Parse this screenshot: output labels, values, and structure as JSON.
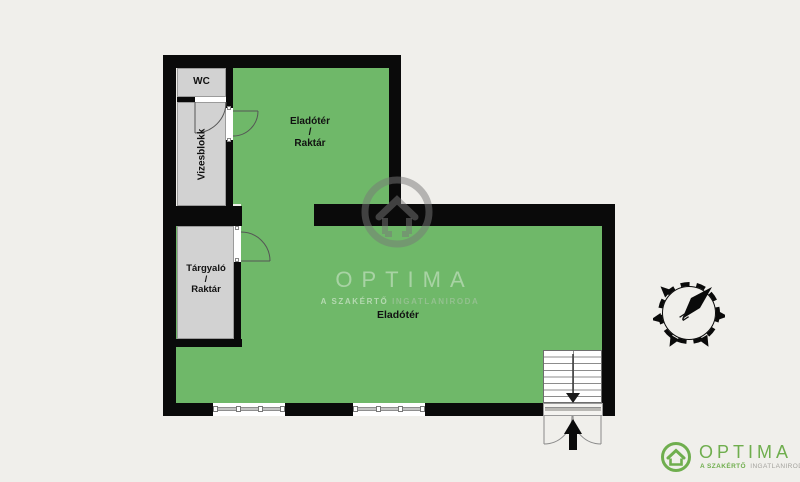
{
  "page": {
    "background_color": "#f0efeb"
  },
  "floorplan": {
    "colors": {
      "floor": "#6fb869",
      "wall": "#0a0a0a",
      "room_fill": "#d2d2d2",
      "brand_green": "#6fae4e"
    },
    "rooms": {
      "wc": {
        "label": "WC"
      },
      "wet_block": {
        "label": "Vizesblokk"
      },
      "meeting_storage": {
        "lines": [
          "Tárgyaló",
          "/",
          "Raktár"
        ]
      },
      "sales_storage": {
        "lines": [
          "Eladótér",
          "/",
          "Raktár"
        ]
      },
      "sales_floor": {
        "label": "Eladótér"
      }
    },
    "compass": {
      "north_label": "N"
    }
  },
  "watermark": {
    "brand": "OPTIMA",
    "tagline": "A SZAKÉRTŐ INGATLANIRODA"
  },
  "logo": {
    "brand": "OPTIMA",
    "tagline_strong": "A SZAKÉRTŐ",
    "tagline_rest": "INGATLANIRODA"
  }
}
